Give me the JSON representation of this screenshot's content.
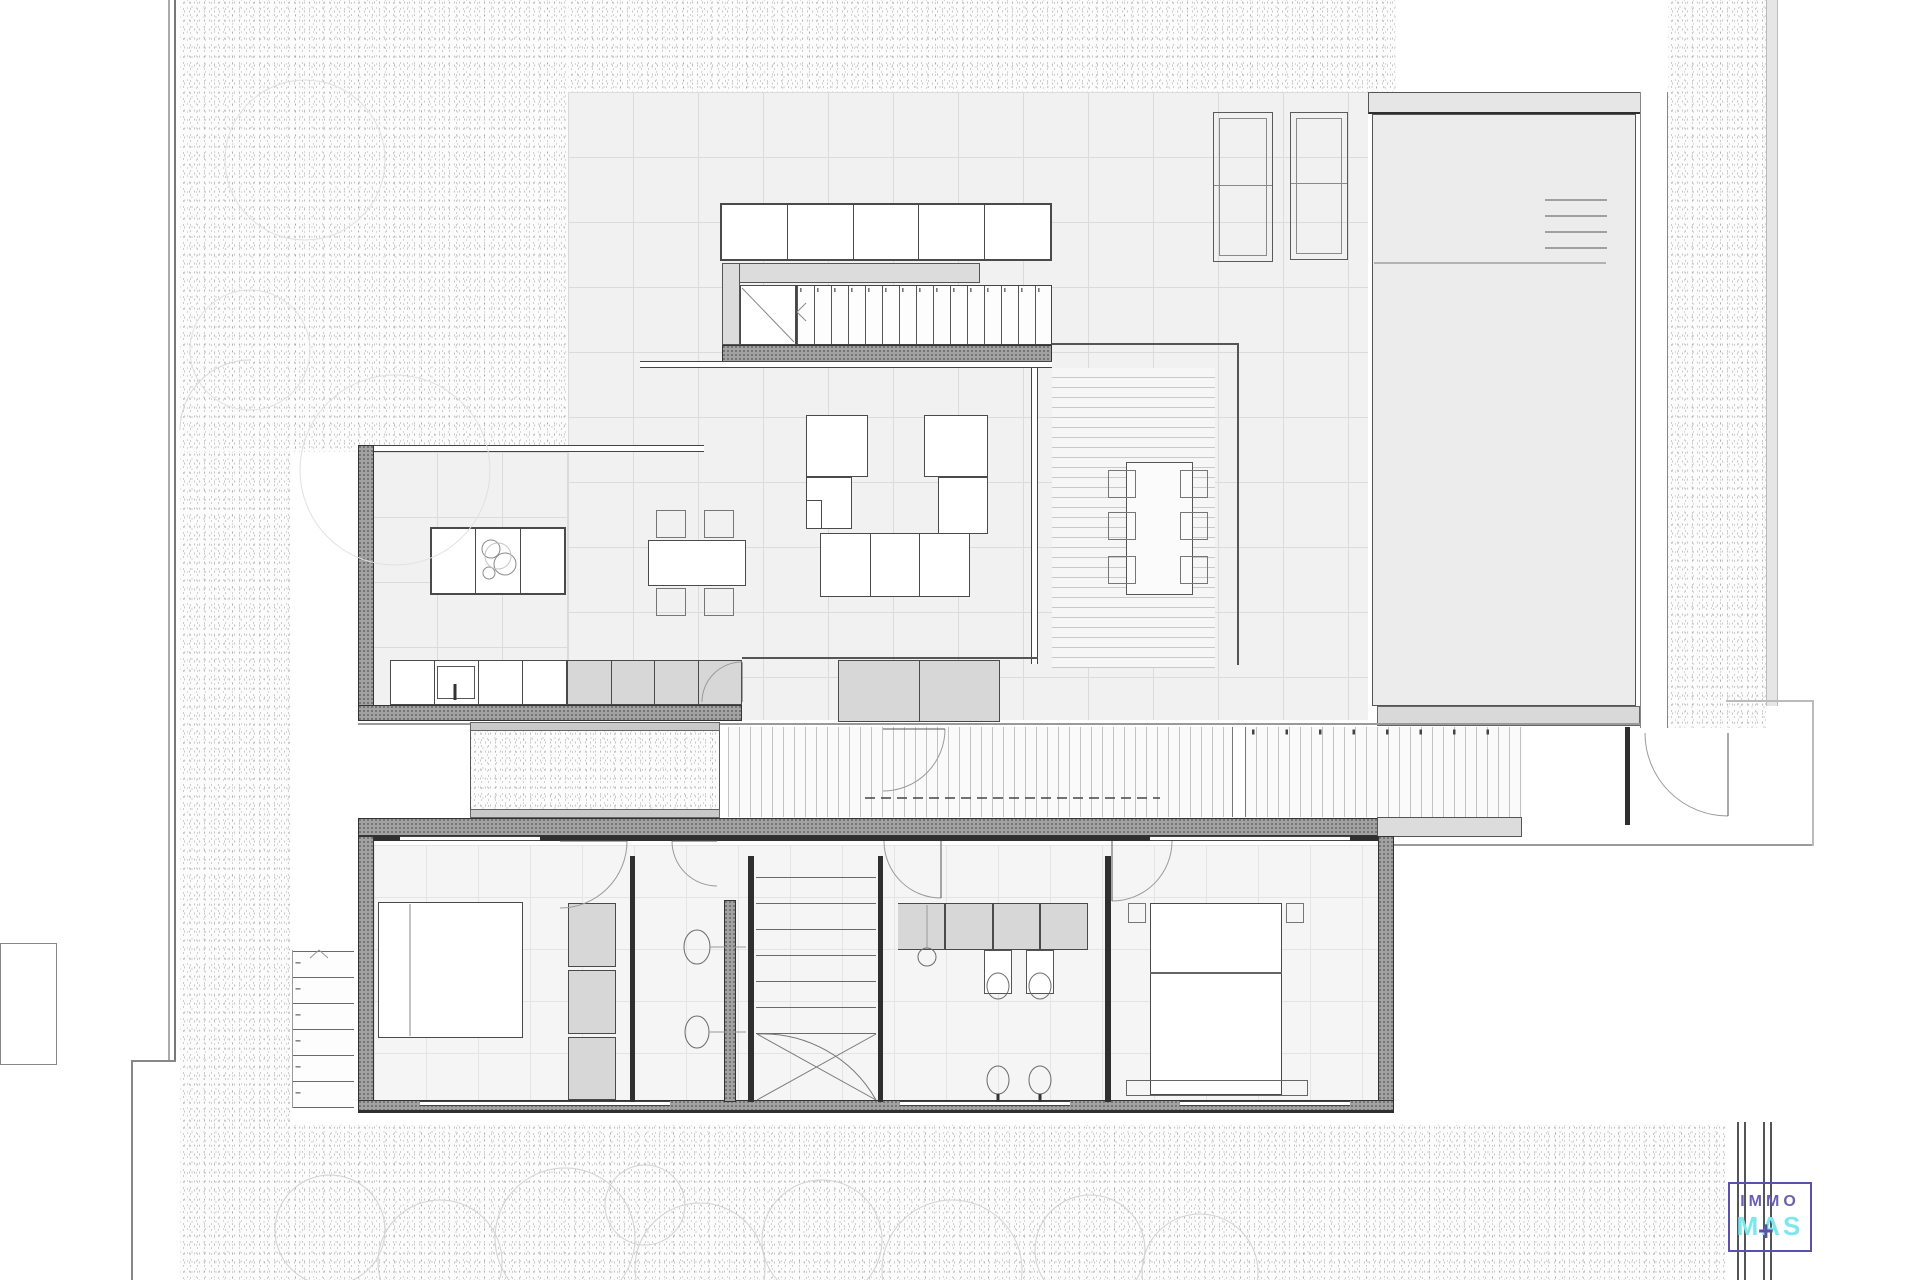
{
  "document": {
    "kind": "architectural floor plan drawing",
    "sheet_background": "#ffffff",
    "visible_text_note": "plan itself contains no readable labels; only the agency logo bottom-right"
  },
  "logo": {
    "line1": "IMMO",
    "line2": "MAS",
    "plus_glyph": "+",
    "frame_color": "#5b51a8",
    "immo_color": "#6a5fb5",
    "mas_color": "#7de7ee",
    "plus_color": "#5b51a8"
  },
  "palette": {
    "stipple_dot": "#a8a8a8",
    "paving_fill": "#f1f1f1",
    "paving_grid_line": "#dbdbdb",
    "interior_fill": "#f5f5f5",
    "wall_dark": "#2f2f2f",
    "wall_hatched": "#a2a2a2",
    "furniture_gray": "#d7d7d7",
    "pool_water": "#ececec",
    "pool_coping": "#e6e6e6",
    "deck_slat_line": "#c2c2c2",
    "tree_outline": "#d2d2d2",
    "boundary_line": "#8f8f8f"
  },
  "icons": {
    "pool_ladder": "horizontal rungs",
    "stair_direction_upper": "chevron-left",
    "stair_direction_exterior": "chevron-up",
    "cooktop_burners": "circles",
    "sink_basin": "ellipse",
    "toilet": "ellipse",
    "door_swing": "quarter-arc",
    "tree": "circle outline",
    "logo_plus": "+"
  }
}
